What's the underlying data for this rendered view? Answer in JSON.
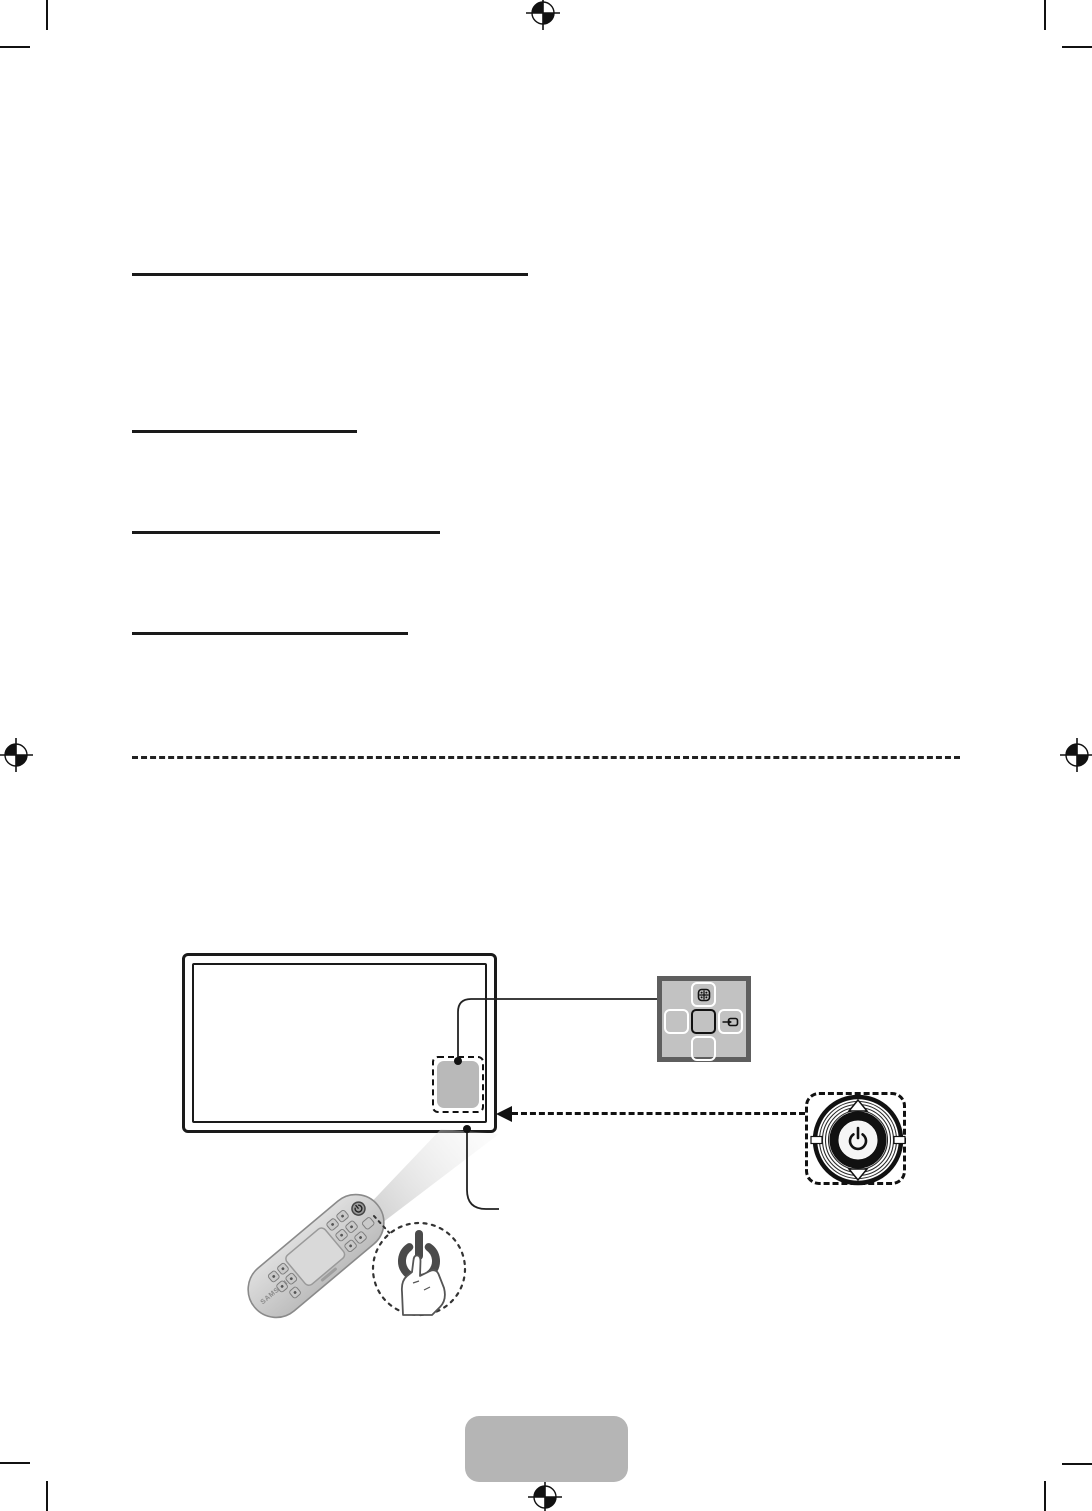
{
  "page": {
    "background": "#ffffff",
    "layout": "print spread page with crop and registration marks, four heading underlines, dashed section divider, hardware diagrams"
  },
  "remote": {
    "brand": "SAMSUNG"
  },
  "icons": {
    "registration_mark": "print registration target (circle, crosshair, filled opposite quadrants)",
    "crop_mark": "corner trim mark line",
    "menu_icon": "grid/menu glyph on controller up key",
    "source_icon": "source-input glyph on controller right key",
    "power_icon": "power symbol at center of jog controller",
    "power_symbol": "magnified thick power symbol",
    "hand_icon": "finger pressing the power symbol",
    "beam": "light beam from remote to TV sensor"
  },
  "colors": {
    "line": "#1a1a1a",
    "sensor_panel_gray": "#b9b9b9",
    "pad_frame": "#5e5e5e",
    "pad_fill": "#c2c2c2",
    "pad_button_border": "#ffffff",
    "badge_gray": "#b5b5b5",
    "remote_body": "#cfcfcf",
    "beam_gray": "#dcdcdc",
    "dial_center": "#f5f5f5",
    "magnified_power": "#4a4a4a"
  }
}
